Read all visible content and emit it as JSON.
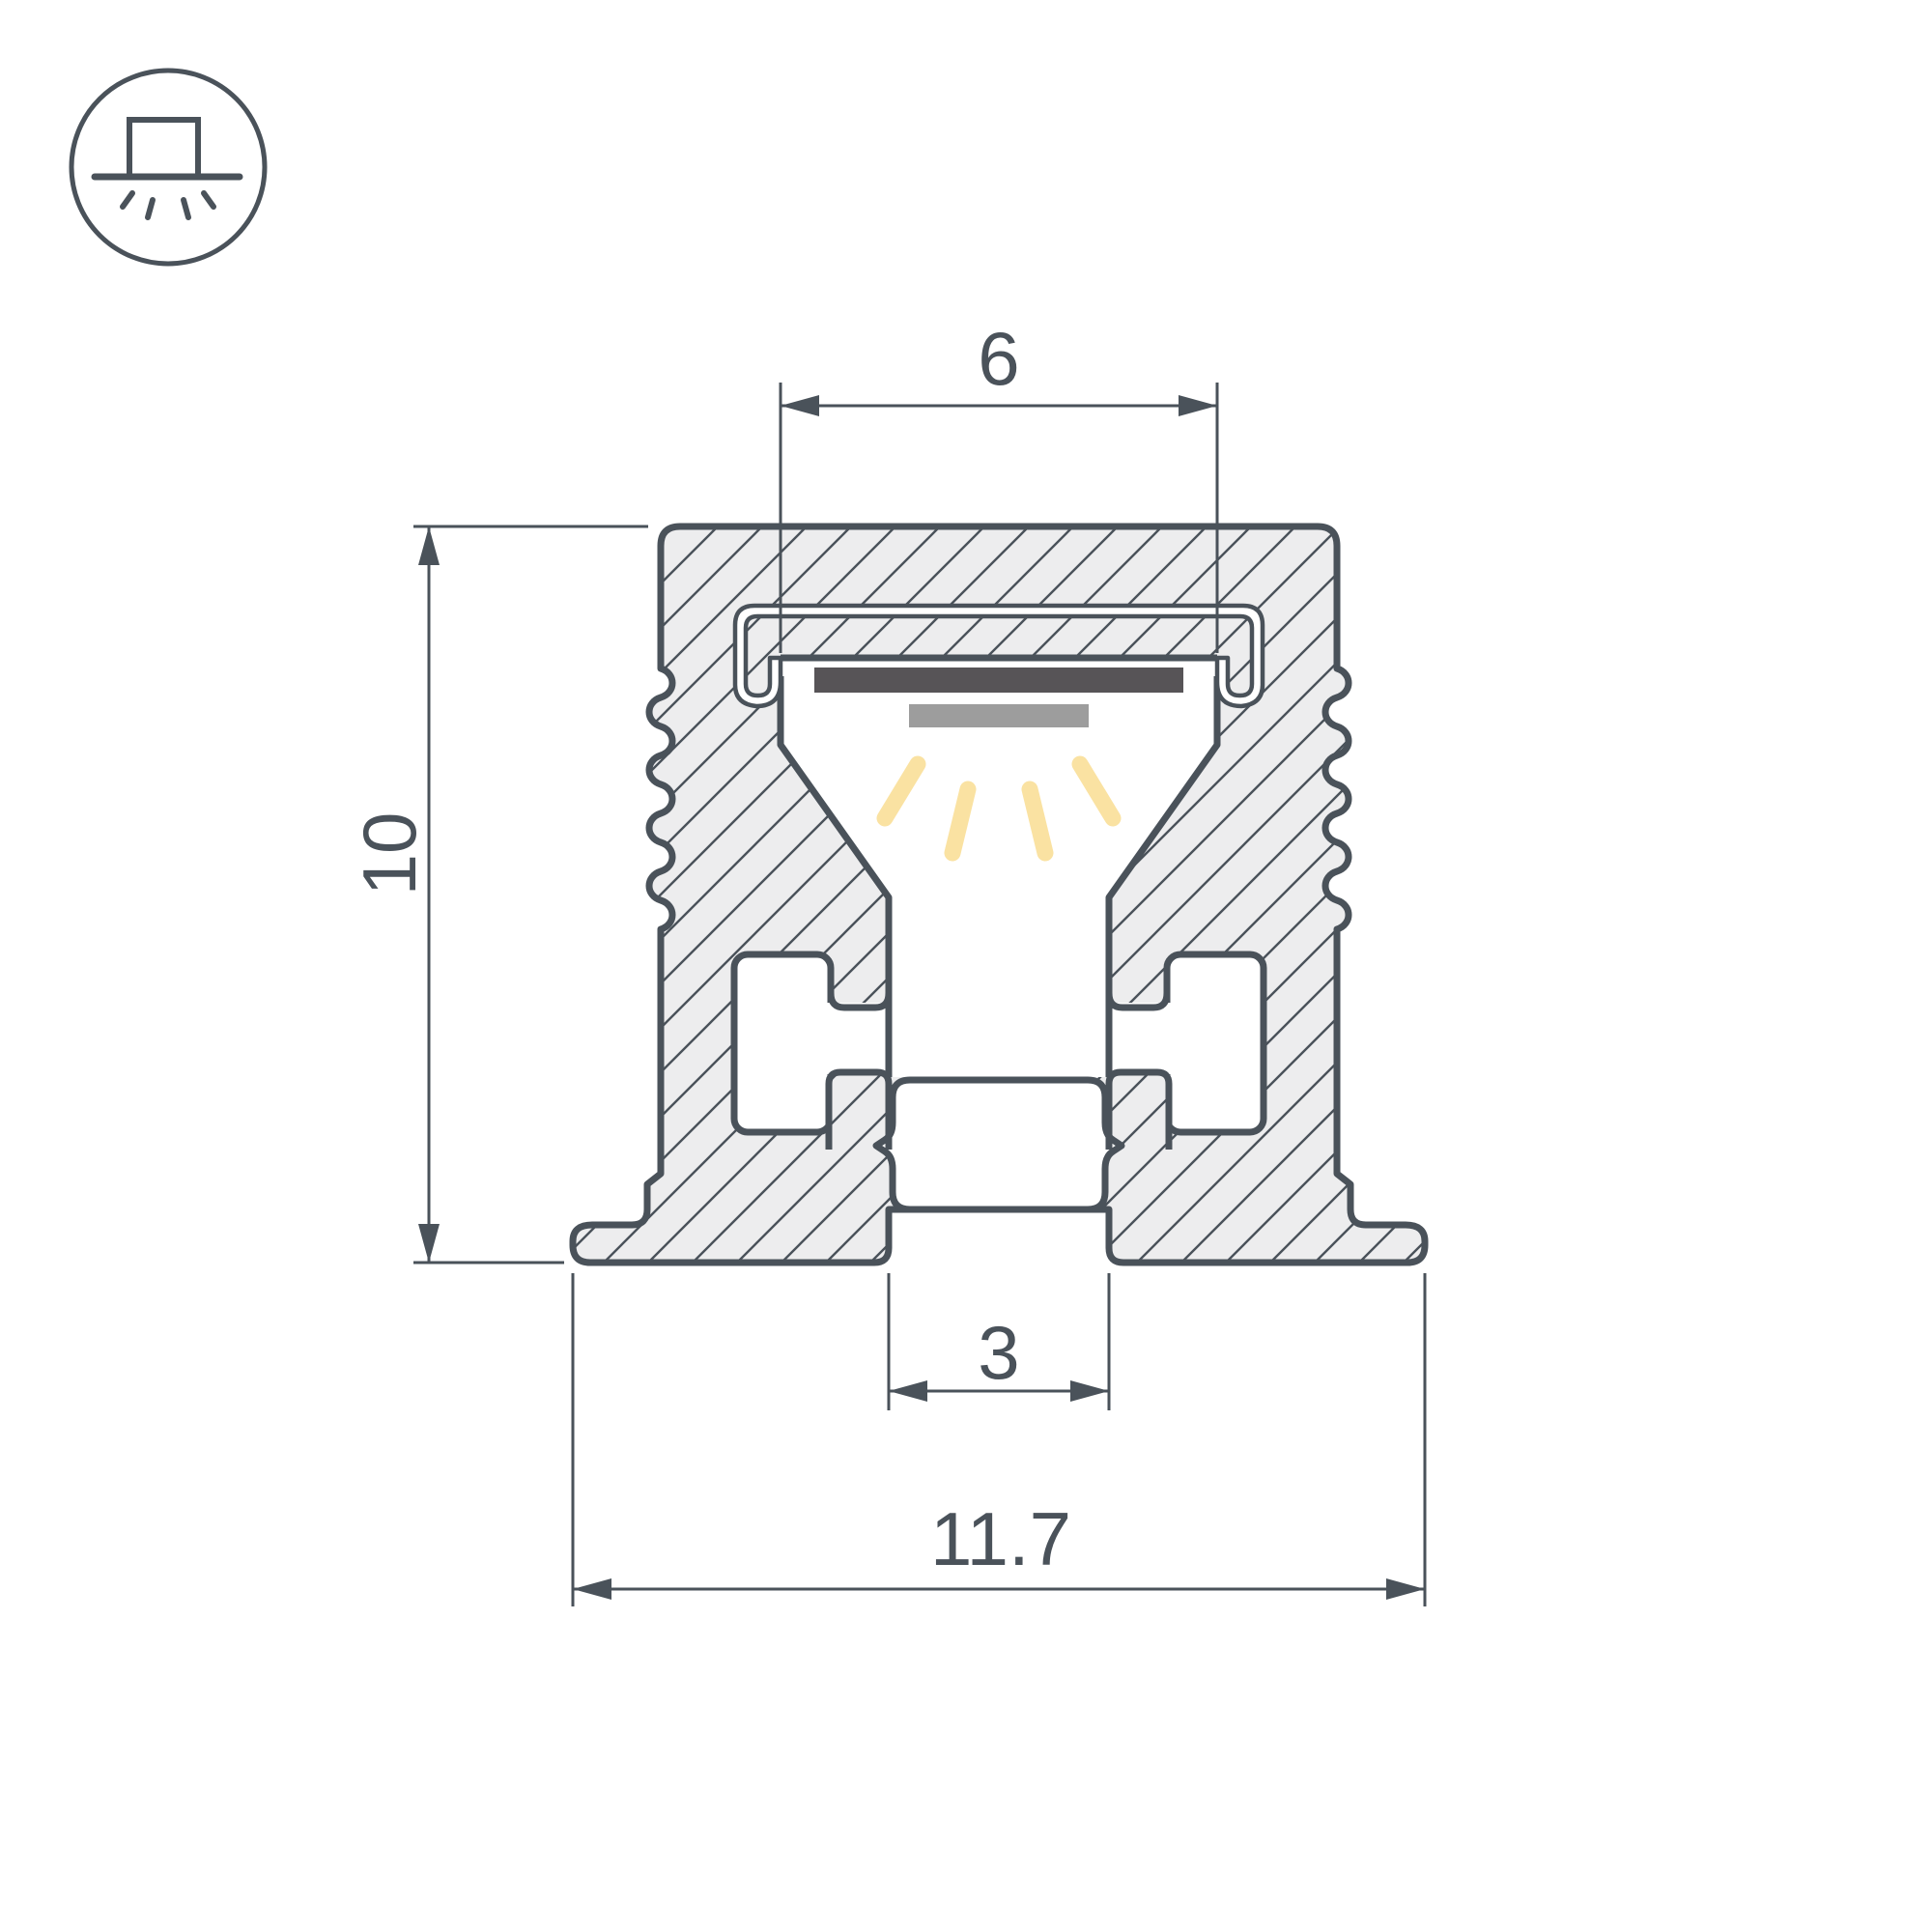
{
  "drawing": {
    "type": "led-profile-cross-section",
    "dimensions": {
      "top_opening": "6",
      "height": "10",
      "bottom_slot": "3",
      "total_width": "11.7"
    },
    "icon": {
      "name": "recessed-downlight-icon",
      "description": "surface box on line with light rays below"
    },
    "colors": {
      "line": "#4A525A",
      "aluminum_fill": "#EDEDEE",
      "led_strip": "#575457",
      "pcb": "#9D9D9D",
      "light_rays": "#FAE2A2",
      "background": "#FFFFFF"
    }
  }
}
